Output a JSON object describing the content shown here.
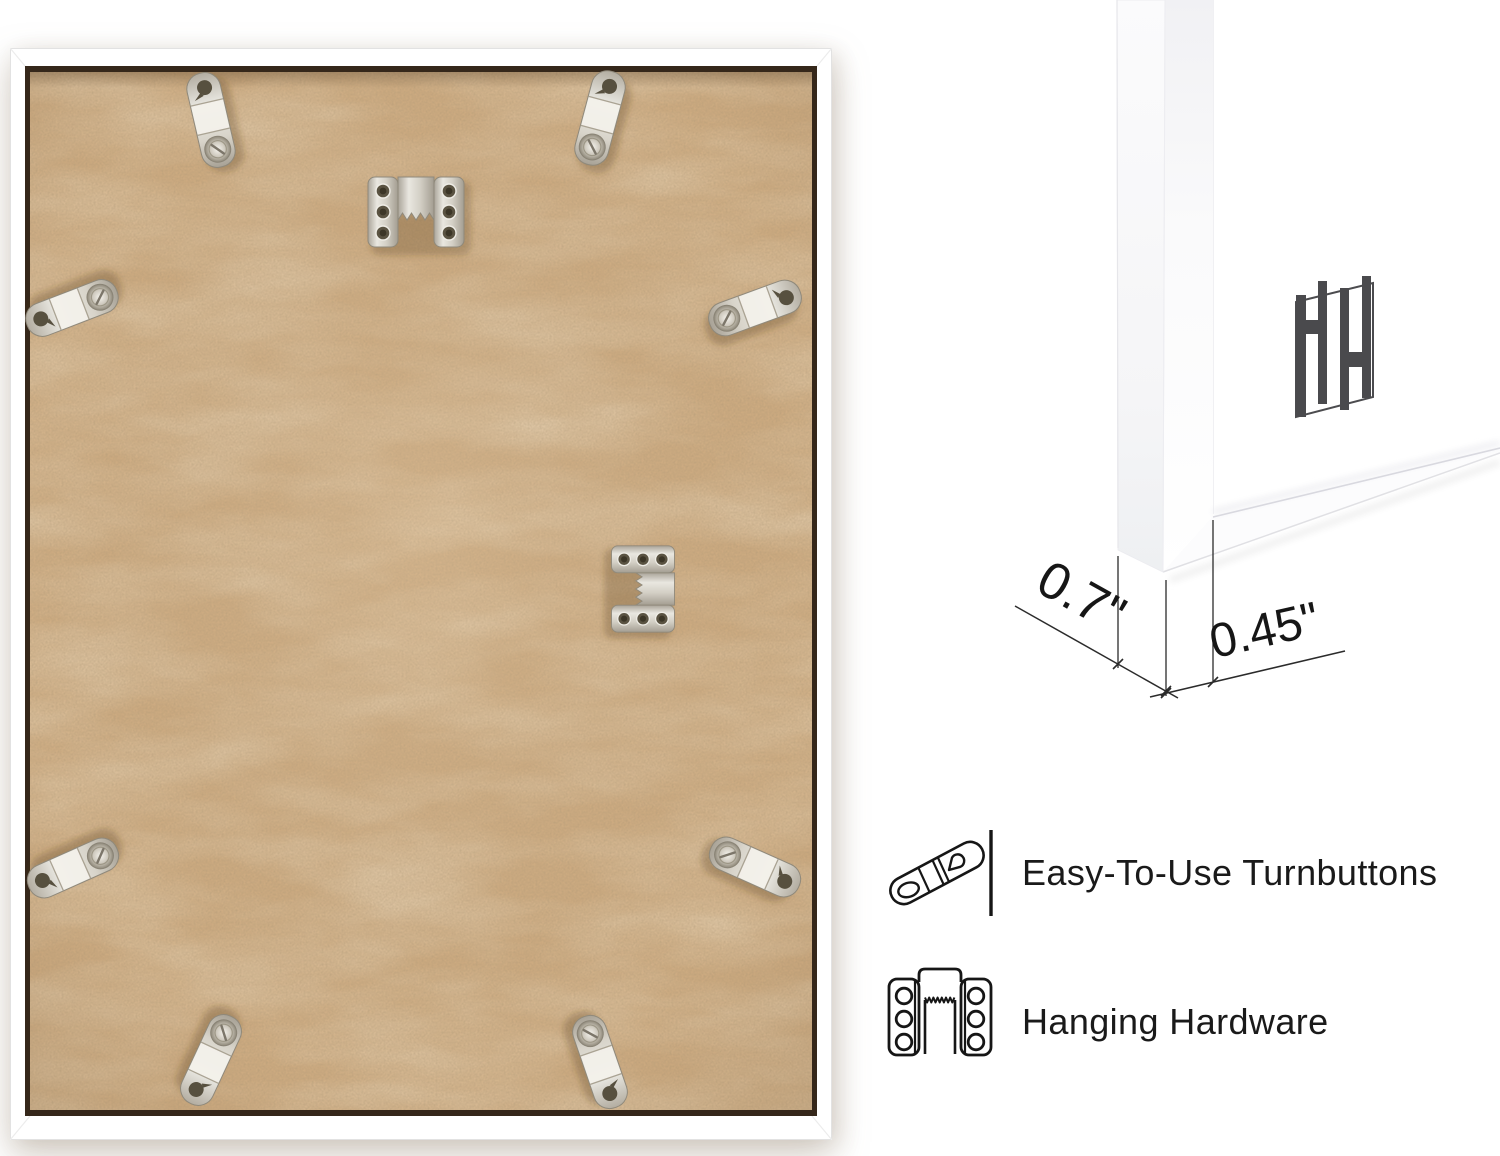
{
  "measurements": {
    "frame_depth": "0.7\"",
    "frame_face_width": "0.45\""
  },
  "features": [
    {
      "id": "turnbuttons",
      "icon": "turnbutton-icon",
      "label": "Easy-To-Use Turnbuttons"
    },
    {
      "id": "hanging_hardware",
      "icon": "sawtooth-hanger-icon",
      "label": "Hanging Hardware"
    }
  ],
  "brand": {
    "monogram": "HH"
  },
  "panel": {
    "board_color": "#cdab81",
    "frame_color": "#ffffff",
    "hardware_metal_color": "#d9d5cc",
    "turnbutton_count": 8,
    "sawtooth_hanger_count": 2
  },
  "colors": {
    "text": "#1a1a1a",
    "dimension_line": "#2b2b2b",
    "logo": "#4a4a4d",
    "background": "#ffffff"
  }
}
